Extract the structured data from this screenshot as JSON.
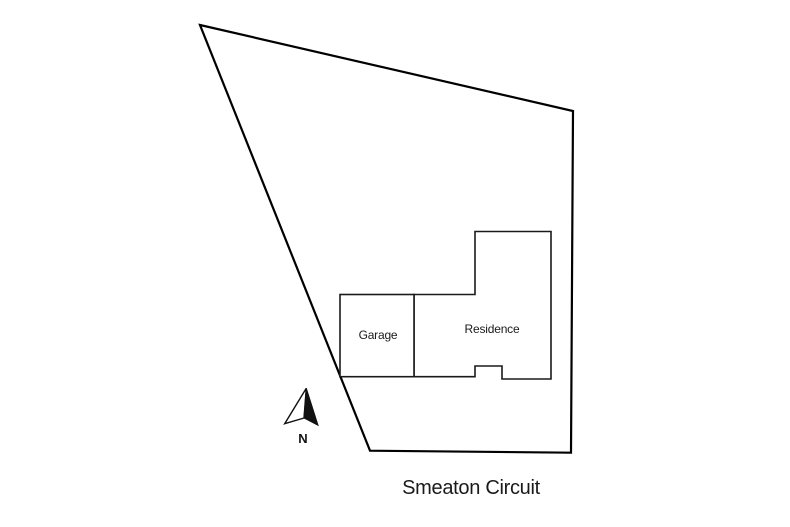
{
  "plan": {
    "title": "Smeaton Circuit",
    "labels": {
      "garage": "Garage",
      "residence": "Residence",
      "north": "N",
      "street": "Smeaton Circuit"
    },
    "icons": {
      "north_arrow": "compass-north-arrow"
    },
    "colors": {
      "background": "#ffffff",
      "boundary_line": "#000000",
      "building_line": "#1a1a1a",
      "text": "#1a1a1a",
      "north_arrow_fill": "#111111"
    }
  }
}
